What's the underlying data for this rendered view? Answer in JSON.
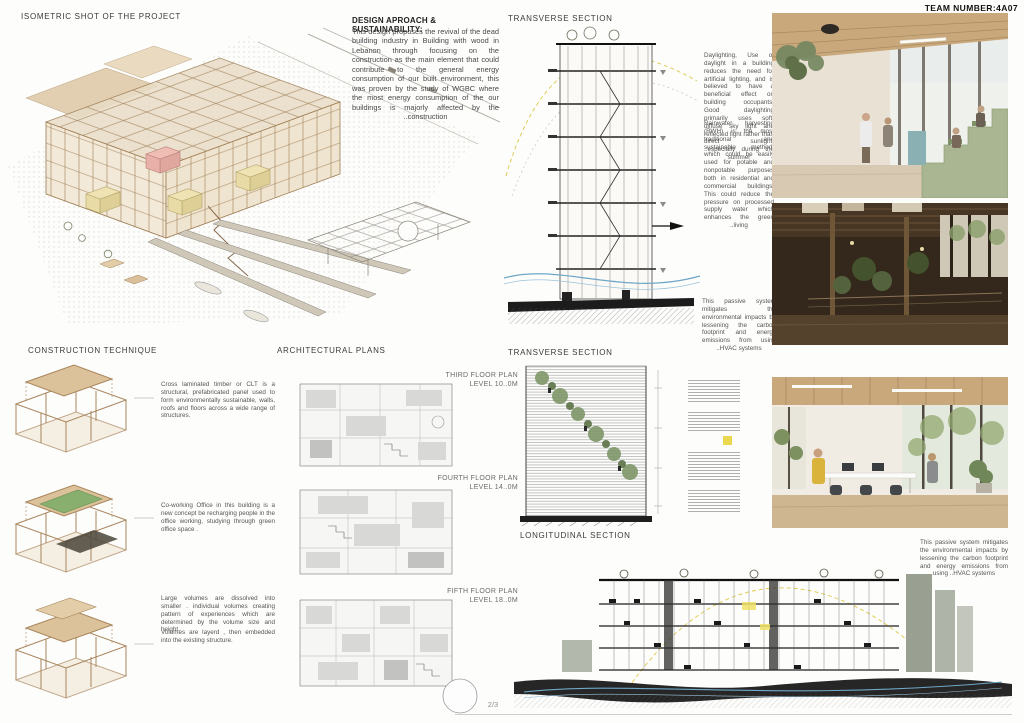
{
  "board": {
    "team_label": "TEAM NUMBER:4A07",
    "page_number": "2/3"
  },
  "accents": {
    "dash_yellow": "#e0cc55",
    "flow_blue": "#6fa7c7",
    "volume_pink": "#e8b0a8",
    "volume_yellow": "#e8dba6",
    "plant_green": "#7d9465",
    "wood_tan": "#a8855c",
    "section_ink": "#1e1e1e"
  },
  "isometric": {
    "title": "ISOMETRIC SHOT OF THE PROJECT"
  },
  "design_approach": {
    "heading": "DESIGN APROACH & SUSTAINABILITY:",
    "body": "This design proposes the revival of the dead building industry in Building with wood in Lebanon through focusing on the construction as the main element that could contribute to the general energy consumption of our built environment, this was proven by the study of WGBC where the most energy consumption of the our buildings is majorly affected by the ..construction"
  },
  "transverse_top": {
    "title": "TRANSVERSE SECTION",
    "note_daylighting": "Daylighting, Use of daylight in a building reduces the need for artificial lighting, and is believed to have a beneficial effect on building occupants. Good daylighting primarily uses soft, diffuse sky light and reflected light rather than direct sunlight, ..especially during the summer",
    "note_rainwater": "Rainwater harvesting (RWH) is the most traditional and sustainable method, which could be easily used for potable and nonpotable purposes both in residential and commercial buildings. This could reduce the pressure on processed supply water which enhances the green ..living",
    "note_passive": "This passive system mitigates the environmental impacts by lessening the carbon footprint and energy emissions from using ..HVAC systems"
  },
  "construction": {
    "title": "CONSTRUCTION TECHNIQUE",
    "note_clt": "Cross laminated timber or CLT is a structural, prefabricated panel used to form environmentally sustainable, walls, roofs and floors across a wide range of structures.",
    "note_coworking": "Co-working Office in this building is a new concept be recharging people in the office working, studying through green office space .",
    "note_volumes_1": "Large volumes are dissolved into smaller . individual volumes creating pattern of experiences which are determined by the volume size and height.",
    "note_volumes_2": "Volumes are layerd , then embedded into the existing structure."
  },
  "plans": {
    "title": "ARCHITECTURAL PLANS",
    "items": [
      {
        "label": "THIRD FLOOR PLAN",
        "level": "LEVEL 10..0M"
      },
      {
        "label": "FOURTH FLOOR PLAN",
        "level": "LEVEL 14..0M"
      },
      {
        "label": "FIFTH FLOOR PLAN",
        "level": "LEVEL 18..0M"
      }
    ]
  },
  "transverse_bottom": {
    "title": "TRANSVERSE SECTION"
  },
  "longitudinal": {
    "title": "LONGITUDINAL SECTION",
    "note_passive": "This passive system mitigates the environmental impacts by lessening the carbon footprint and energy emissions from using ..HVAC systems"
  }
}
